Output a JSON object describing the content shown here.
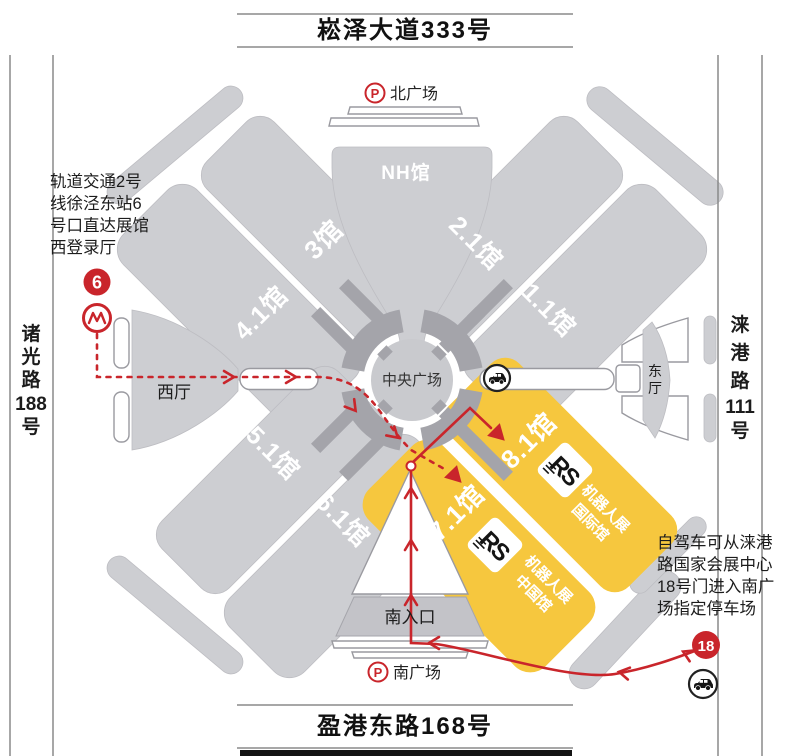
{
  "title_banners": {
    "top": "崧泽大道333号",
    "bottom": "盈港东路168号"
  },
  "roads": {
    "left": [
      "诸",
      "光",
      "路",
      "188",
      "号"
    ],
    "right": [
      "涞",
      "港",
      "路",
      "111",
      "号"
    ]
  },
  "plazas": {
    "parking_symbol": "P",
    "north": "北广场",
    "south": "南广场",
    "central": "中央广场"
  },
  "halls": {
    "nh": "NH馆",
    "h1_1": "1.1馆",
    "h2_1": "2.1馆",
    "h3": "3馆",
    "h4_1": "4.1馆",
    "h5_1": "5.1馆",
    "h6_1": "6.1馆",
    "h7_1": "7.1馆",
    "h8_1": "8.1馆"
  },
  "entrances": {
    "west": "西厅",
    "east_top": "东",
    "east_bottom": "厅",
    "south": "南入口"
  },
  "notes": {
    "metro_access": [
      "轨道交通2号",
      "线徐泾东站6",
      "号口直达展馆",
      "西登录厅"
    ],
    "driving": [
      "自驾车可从涞港",
      "路国家会展中心",
      "18号门进入南广",
      "场指定停车场"
    ]
  },
  "markers": {
    "metro_exit_number": "6",
    "gate_number": "18"
  },
  "expo": {
    "logo": "RS",
    "robot_expo": "机器人展",
    "international_hall": "国际馆",
    "china_hall": "中国馆"
  },
  "colors": {
    "route_red": "#c9252b",
    "hall_yellow": "#f6c73e",
    "hall_gray": "#cdced2",
    "dark_gray": "#a4a4aa"
  }
}
